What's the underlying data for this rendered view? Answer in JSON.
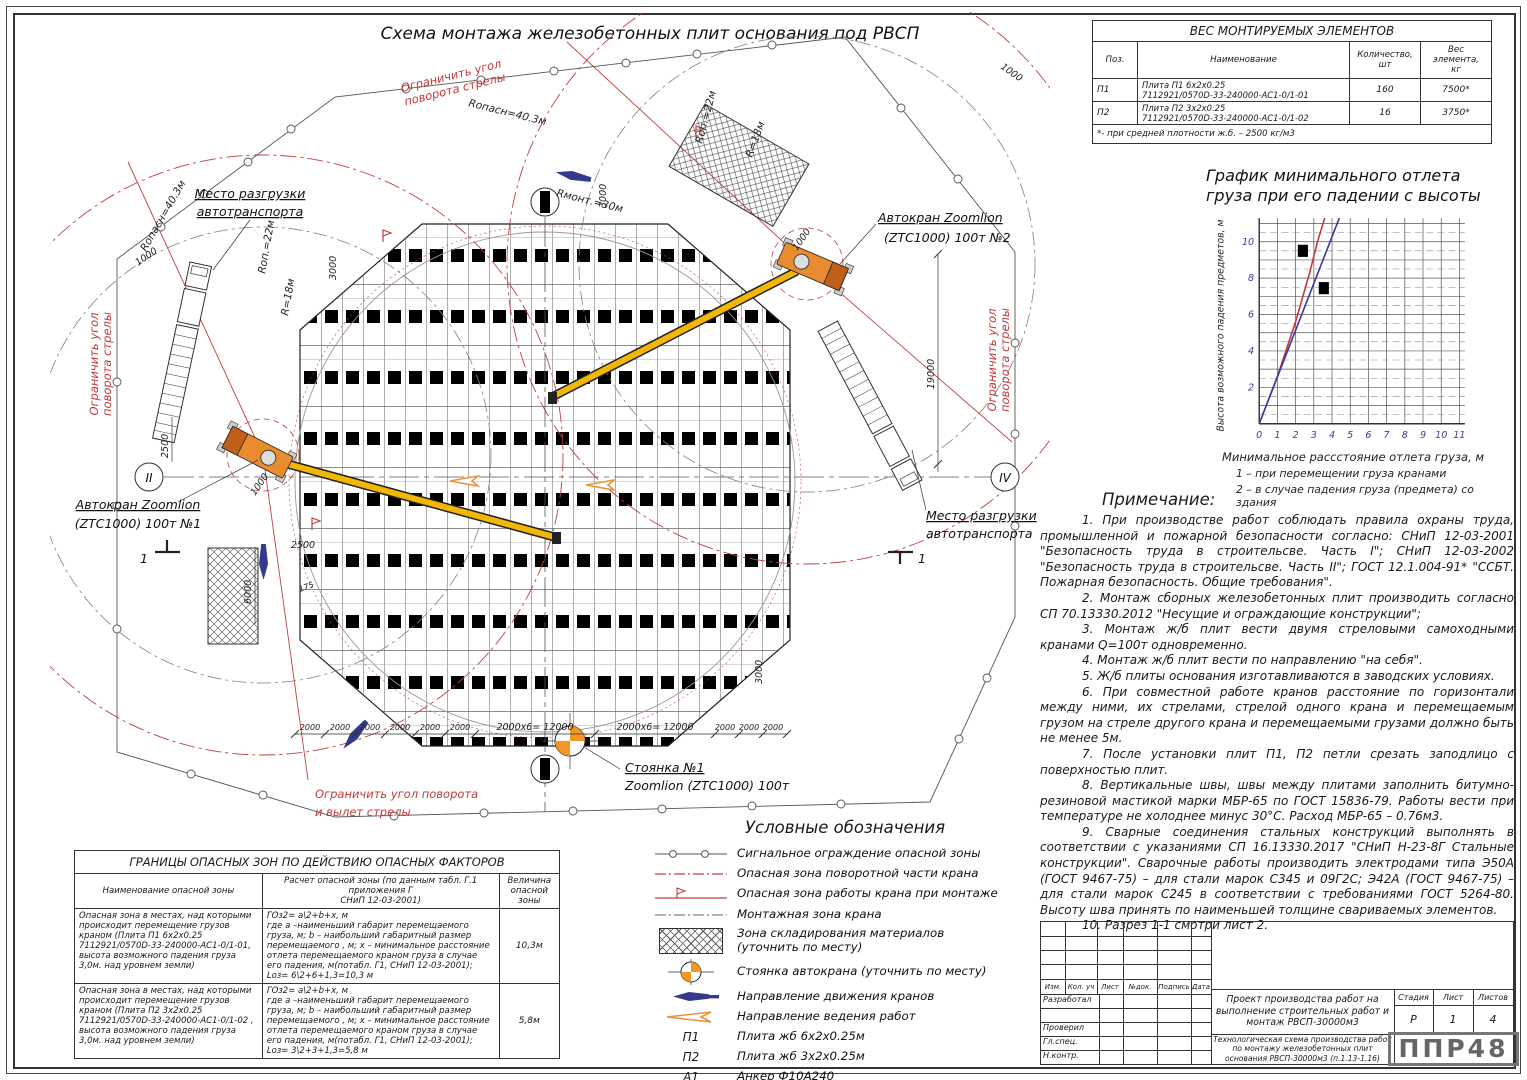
{
  "title": "Схема монтажа железобетонных плит основания под РВСП",
  "weights_table": {
    "title": "ВЕС МОНТИРУЕМЫХ ЭЛЕМЕНТОВ",
    "col_pos": "Поз.",
    "col_name": "Наименование",
    "col_qty": "Количество,\nшт",
    "col_weight": "Вес\nэлемента,\nкг",
    "rows": [
      {
        "pos": "П1",
        "name": "Плита П1 6х2х0.25\n7112921/0570D-33-240000-АС1-0/1-01",
        "qty": "160",
        "weight": "7500*"
      },
      {
        "pos": "П2",
        "name": "Плита П2 3х2х0.25\n7112921/0570D-33-240000-АС1-0/1-02",
        "qty": "16",
        "weight": "3750*"
      }
    ],
    "footnote": "*- при средней плотности ж.б. – 2500 кг/м3"
  },
  "chart_data": {
    "type": "line",
    "title": "График минимального отлета\nгруза при его падении с высоты",
    "xlabel": "Минимальное рассстояние отлета груза, м",
    "ylabel": "Высота возможного падения предметов, м",
    "xlim": [
      0,
      11.3
    ],
    "ylim": [
      0,
      11.3
    ],
    "x_ticks": [
      0,
      1,
      2,
      3,
      4,
      5,
      6,
      7,
      8,
      9,
      10,
      11
    ],
    "y_ticks": [
      2,
      4,
      6,
      8,
      10
    ],
    "grid": true,
    "legend_position": "below",
    "series": [
      {
        "name": "1 – при перемещении груза кранами",
        "color": "#c23b3b",
        "points": [
          [
            0,
            0
          ],
          [
            1,
            2.6
          ],
          [
            2,
            5.6
          ],
          [
            2.8,
            8.4
          ],
          [
            3.2,
            10
          ],
          [
            3.6,
            11.3
          ]
        ]
      },
      {
        "name": "2 – в случае падения груза (предмета) со здания",
        "color": "#3a3aa0",
        "points": [
          [
            0,
            0
          ],
          [
            4.4,
            11.3
          ]
        ]
      }
    ],
    "markers": [
      [
        2.4,
        9.5
      ],
      [
        3.55,
        7.45
      ]
    ]
  },
  "notes": {
    "heading": "Примечание:",
    "items": [
      "1.   При производстве работ соблюдать правила охраны труда, промышленной и пожарной безопасности согласно: СНиП 12-03-2001 \"Безопасность труда в строительсве. Часть I\"; СНиП 12-03-2002 \"Безопасность труда в строительсве. Часть II\"; ГОСТ 12.1.004-91* \"ССБТ. Пожарная безопасность. Общие требования\".",
      "2.   Монтаж сборных железобетонных плит производить согласно СП 70.13330.2012 \"Несущие и ограждающие конструкции\";",
      "3.   Монтаж ж/б плит вести двумя стреловыми самоходными кранами Q=100т одновременно.",
      "4.   Монтаж ж/б плит вести по направлению \"на себя\".",
      "5.   Ж/б плиты основания изготавливаются в заводских условиях.",
      "6.   При совместной работе кранов расстояние по горизонтали между ними, их стрелами, стрелой одного крана и перемещаемым грузом на стреле другого крана и перемещаемыми грузами должно быть не менее 5м.",
      "7.   После установки плит П1, П2 петли срезать заподлицо с поверхностью плит.",
      "8.   Вертикальные швы, швы между плитами заполнить битумно-резиновой мастикой марки МБР-65 по ГОСТ 15836-79. Работы вести при температуре не холоднее минус 30°С. Расход МБР-65 – 0.76м3.",
      "9.   Сварные соединения стальных конструкций выполнять в соответствии с указаниями СП 16.13330.2017 \"СНиП Н-23-8Г Стальные конструкции\". Сварочные работы производить электродами типа Э50А (ГОСТ 9467-75) – для стали марок С345 и 09Г2С; Э42А (ГОСТ 9467-75) – для стали марок С245 в соответствии с требованиями ГОСТ 5264-80. Высоту шва принять по наименьшей толщине свариваемых элементов.",
      "10.   Разрез 1-1 смотри лист 2."
    ]
  },
  "hazard_table": {
    "title": "ГРАНИЦЫ ОПАСНЫХ ЗОН ПО ДЕЙСТВИЮ ОПАСНЫХ ФАКТОРОВ",
    "col_name": "Наименование опасной зоны",
    "col_calc": "Расчет опасной зоны (по данным табл. Г.1 приложения Г\nСНиП 12-03-2001)",
    "col_value": "Величина\nопасной\nзоны",
    "rows": [
      {
        "name": "Опасная зона в местах, над которыми происходит перемещение грузов краном (Плита П1 6х2х0.25 7112921/0570D-33-240000-АС1-0/1-01, высота возможного падения груза 3,0м. над уровнем земли)",
        "calc": "ГОз2= а\\2+b+х, м\nгде а –наименьший габарит перемещаемого груза, м; b – наибольший габаритный размер перемещаемого , м; х – минимальное расстояние отлета перемещаемого краном груза в случае его падения, м(потабл. Г1, СНиП 12-03-2001); Lоз= 6\\2+6+1,3=10,3 м",
        "value": "10,3м"
      },
      {
        "name": "Опасная зона в местах, над которыми происходит перемещение грузов краном (Плита П2 3х2х0.25 7112921/0570D-33-240000-АС1-0/1-02 , высота возможного падения груза 3,0м. над уровнем земли)",
        "calc": "ГОз2= а\\2+b+х, м\nгде а –наименьший габарит перемещаемого груза, м; b – наибольший габаритный размер перемещаемого , м; х – минимальное расстояние отлета перемещаемого краном груза в случае его падения, м(потабл. Г1, СНиП 12-03-2001); Lоз= 3\\2+3+1,3=5,8 м",
        "value": "5,8м"
      }
    ]
  },
  "legend": {
    "title": "Условные обозначения",
    "items": [
      {
        "key": "",
        "label": "Сигнальное ограждение опасной зоны"
      },
      {
        "key": "",
        "label": "Опасная зона поворотной части крана"
      },
      {
        "key": "",
        "label": "Опасная зона работы крана при монтаже"
      },
      {
        "key": "",
        "label": "Монтажная зона крана"
      },
      {
        "key": "",
        "label": "Зона складирования материалов\n(уточнить по месту)"
      },
      {
        "key": "",
        "label": "Стоянка автокрана (уточнить по месту)"
      },
      {
        "key": "",
        "label": "Направление движения кранов"
      },
      {
        "key": "",
        "label": "Направление ведения работ"
      },
      {
        "key": "П1",
        "label": "Плита жб 6х2х0.25м"
      },
      {
        "key": "П2",
        "label": "Плита жб 3х2х0.25м"
      },
      {
        "key": "А1",
        "label": "Анкер Ф10А240"
      }
    ]
  },
  "title_block": {
    "cols": [
      "Изм.",
      "Кол. уч",
      "Лист",
      "№док.",
      "Подпись",
      "Дата"
    ],
    "rows": [
      "Разработал",
      "",
      "Проверил",
      "Гл.спец.",
      "Н.контр."
    ],
    "project": "Проект производства работ на выполнение строительных работ и монтаж РВСП-30000м3",
    "stage_label": "Стадия",
    "stage": "Р",
    "sheet_label": "Лист",
    "sheet": "1",
    "sheets_label": "Листов",
    "sheets": "4",
    "doc_title": "Технологическая схема производства работ по монтажу железобетонных плит основания РВСП-30000м3  (п.1.13-1.16)",
    "logo": "ППР48"
  },
  "plan": {
    "axis_left": "II",
    "axis_right": "IV",
    "crane1_label": [
      "Автокран Zoomlion",
      "(ZTC1000) 100т №1"
    ],
    "crane2_label": [
      "Автокран Zoomlion",
      "(ZTC1000) 100т №2"
    ],
    "stand_label": [
      "Стоянка №1",
      "Zoomlion (ZTC1000) 100т"
    ],
    "unload_label": [
      "Место разгрузки",
      "автотранспорта"
    ],
    "limit_label": [
      "Ограничить угол",
      "поворота стрелы"
    ],
    "limit_bottom": [
      "Ограничить угол поворота",
      "и вылет стрелы"
    ],
    "r_opasn": "Rопасн=40.3м",
    "r_mont": "Rмонт.=30м",
    "r_op22": "Rоп.=22м",
    "r_18": "R=18м",
    "d_2500": "2500",
    "d_1000": "1000",
    "d_19000": "19000",
    "d_6000": "6000",
    "d_3000": "3000",
    "d_175": "175",
    "d_2000": "2000",
    "d_12000": "2000х6= 12000",
    "section": "1"
  }
}
